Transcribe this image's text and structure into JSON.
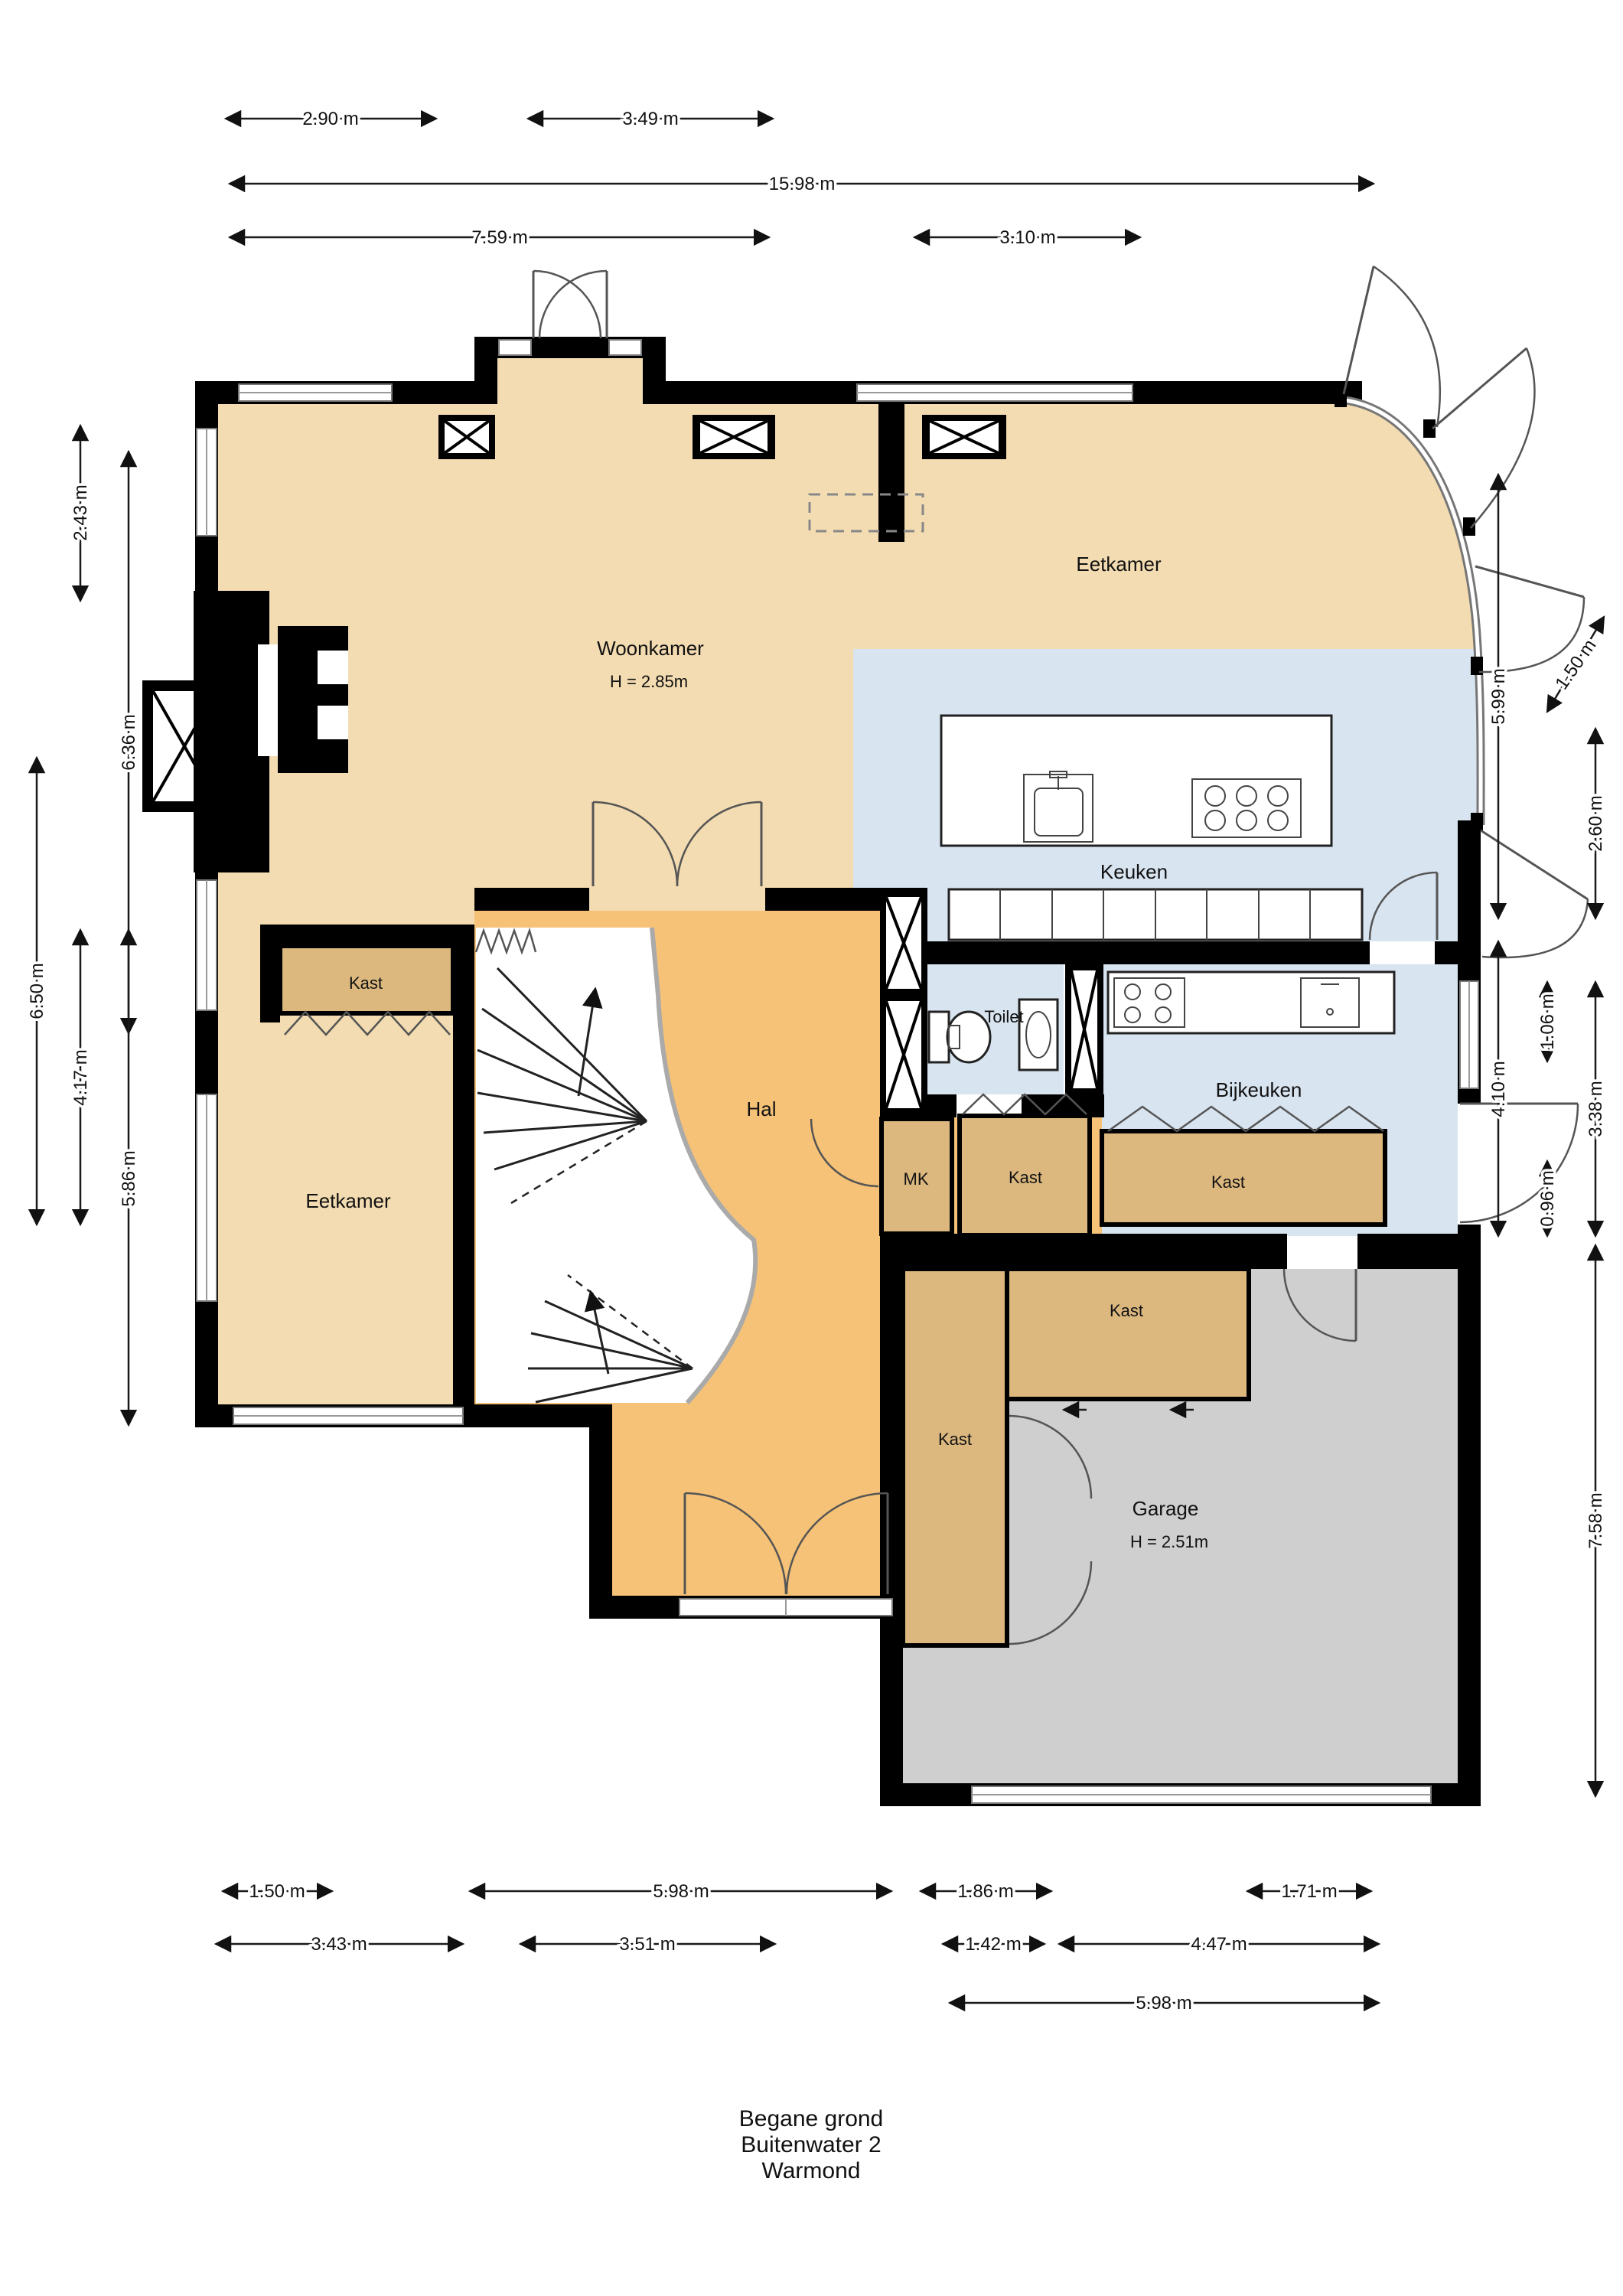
{
  "title": {
    "lines": [
      "Begane grond",
      "Buitenwater 2",
      "Warmond"
    ]
  },
  "rooms": {
    "woonkamer": {
      "label": "Woonkamer",
      "height": "H = 2.85m"
    },
    "eetkamer_top": {
      "label": "Eetkamer"
    },
    "keuken": {
      "label": "Keuken"
    },
    "eetkamer_left": {
      "label": "Eetkamer"
    },
    "hal": {
      "label": "Hal"
    },
    "toilet": {
      "label": "Toilet"
    },
    "bijkeuken": {
      "label": "Bijkeuken"
    },
    "mk": {
      "label": "MK"
    },
    "garage": {
      "label": "Garage",
      "height": "H = 2.51m"
    }
  },
  "closets": [
    {
      "label": "Kast"
    },
    {
      "label": "Kast"
    },
    {
      "label": "Kast"
    },
    {
      "label": "Kast"
    },
    {
      "label": "Kast"
    }
  ],
  "dimensions": {
    "top": [
      "2.90 m",
      "3.49 m",
      "15.98 m",
      "7.59 m",
      "3.10 m"
    ],
    "left": [
      "2.43 m",
      "6.36 m",
      "6.50 m",
      "4.17 m",
      "5.86 m"
    ],
    "right": [
      "5.99 m",
      "1.50 m",
      "2.60 m",
      "4.10 m",
      "1.06 m",
      "0.96 m",
      "3.38 m",
      "7.58 m"
    ],
    "bottom": [
      "1.50 m",
      "5.98 m",
      "1.86 m",
      "1.71 m",
      "3.43 m",
      "3.51 m",
      "1.42 m",
      "4.47 m",
      "5.98 m"
    ]
  },
  "colors": {
    "floor_living": "#F3DCB1",
    "floor_hall": "#F6C277",
    "floor_kitchen": "#D8E4F0",
    "floor_closet": "#DCB87F",
    "floor_garage": "#CFCFCF",
    "wall": "#000000"
  }
}
